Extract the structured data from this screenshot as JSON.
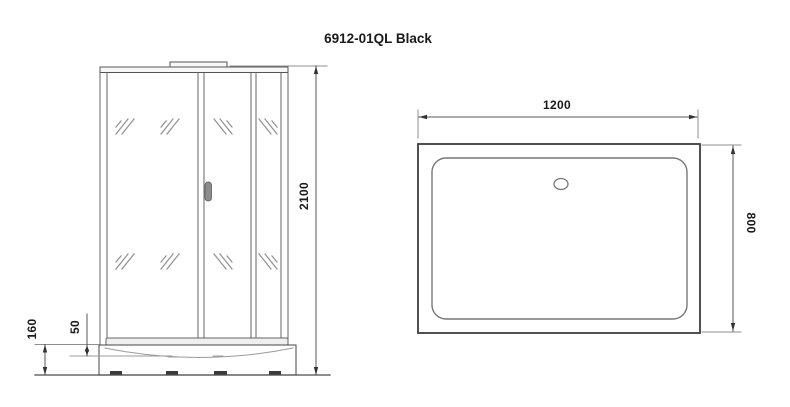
{
  "title": "6912-01QL Black",
  "front_view": {
    "description": "front elevation of shower cabin",
    "dimensions": {
      "height": "2100",
      "tray_height": "160",
      "basin_depth": "50"
    }
  },
  "top_view": {
    "description": "top view of shower tray",
    "dimensions": {
      "width": "1200",
      "depth": "800"
    }
  },
  "colors": {
    "line_dark": "#3d3d3d",
    "line": "#555555",
    "line_light": "#8f8f8f",
    "text": "#1a1a1a",
    "handle_fill": "#8c8c8c",
    "background": "#ffffff"
  }
}
